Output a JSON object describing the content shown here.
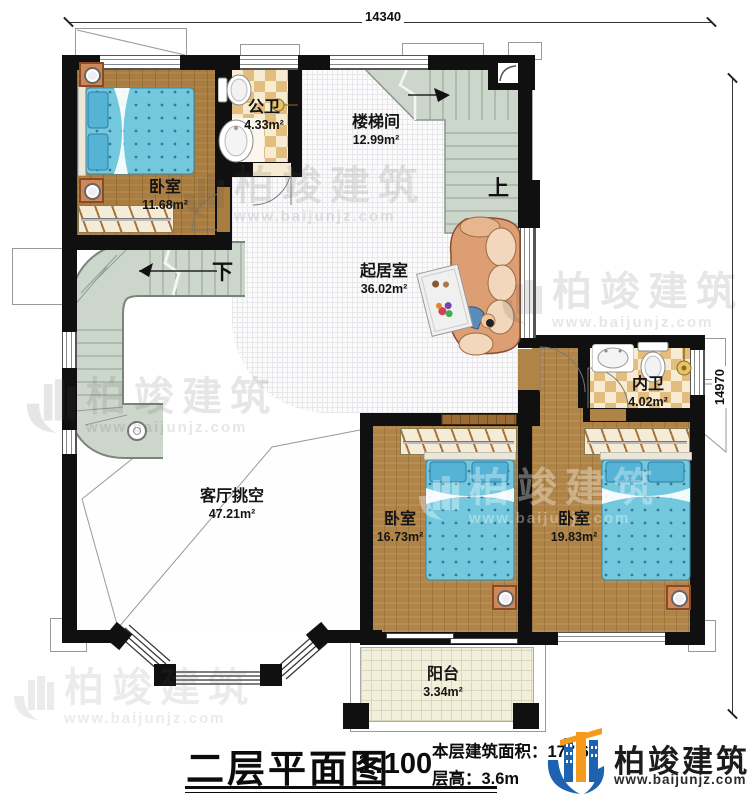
{
  "dimensions": {
    "top": "14340",
    "right": "14970"
  },
  "rooms": [
    {
      "id": "bedroom-tl",
      "name": "卧室",
      "area": "11.68m²"
    },
    {
      "id": "public-bath",
      "name": "公卫",
      "area": "4.33m²"
    },
    {
      "id": "stairwell",
      "name": "楼梯间",
      "area": "12.99m²"
    },
    {
      "id": "living",
      "name": "起居室",
      "area": "36.02m²"
    },
    {
      "id": "inner-bath",
      "name": "内卫",
      "area": "4.02m²"
    },
    {
      "id": "void",
      "name": "客厅挑空",
      "area": "47.21m²"
    },
    {
      "id": "bedroom-b1",
      "name": "卧室",
      "area": "16.73m²"
    },
    {
      "id": "bedroom-b2",
      "name": "卧室",
      "area": "19.83m²"
    },
    {
      "id": "balcony",
      "name": "阳台",
      "area": "3.34m²"
    }
  ],
  "stairs": {
    "up": "上",
    "down": "下"
  },
  "titleblock": {
    "title": "二层平面图",
    "scale": "1:100",
    "area_label": "本层建筑面积：",
    "area_value": "177.6",
    "area_sup": "2",
    "height_label": "层高：",
    "height_value": "3.6m"
  },
  "brand": {
    "name": "柏竣建筑",
    "url": "www.baijunjz.com"
  },
  "watermark": {
    "name": "柏竣建筑",
    "url": "www.baijunjz.com"
  },
  "colors": {
    "accent_blue": "#1e63b0",
    "accent_orange": "#f59a1d",
    "wall": "#101010",
    "stair": "#ccd6cb"
  }
}
